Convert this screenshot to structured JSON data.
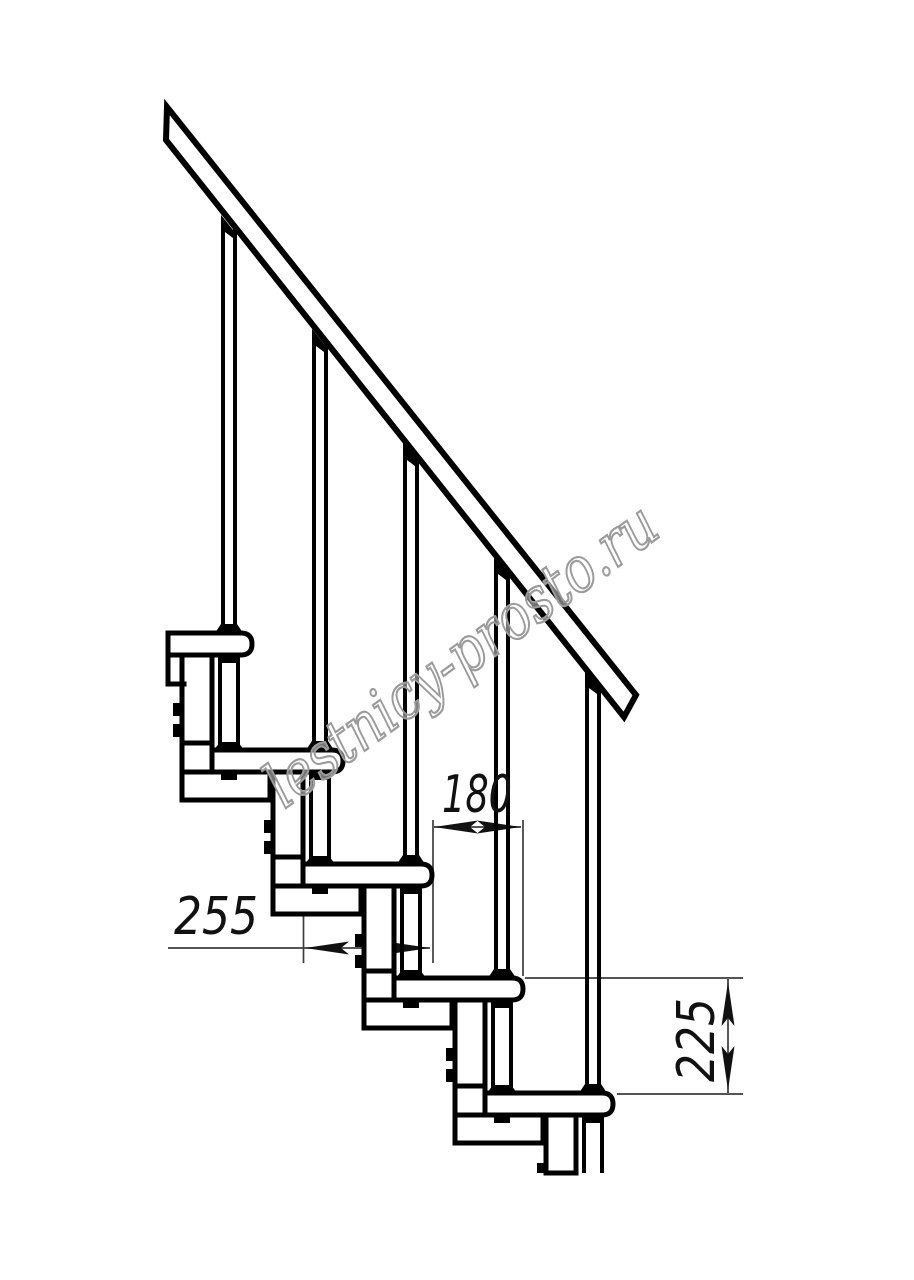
{
  "figure": {
    "description": "Side-view technical line drawing of a modular staircase with handrail, balusters, five treads and support modules",
    "steps_visible": 5,
    "balusters_visible": 5
  },
  "dimensions": {
    "going": {
      "value": "180",
      "orientation": "horizontal"
    },
    "tread_depth": {
      "value": "255",
      "orientation": "horizontal"
    },
    "rise": {
      "value": "225",
      "orientation": "vertical"
    }
  },
  "watermark": {
    "text": "lestnicy-prosto.ru"
  },
  "colors": {
    "line": "#000000",
    "background": "#ffffff",
    "dimension_line": "#3d3d3d",
    "watermark": "#9b9b9b"
  }
}
